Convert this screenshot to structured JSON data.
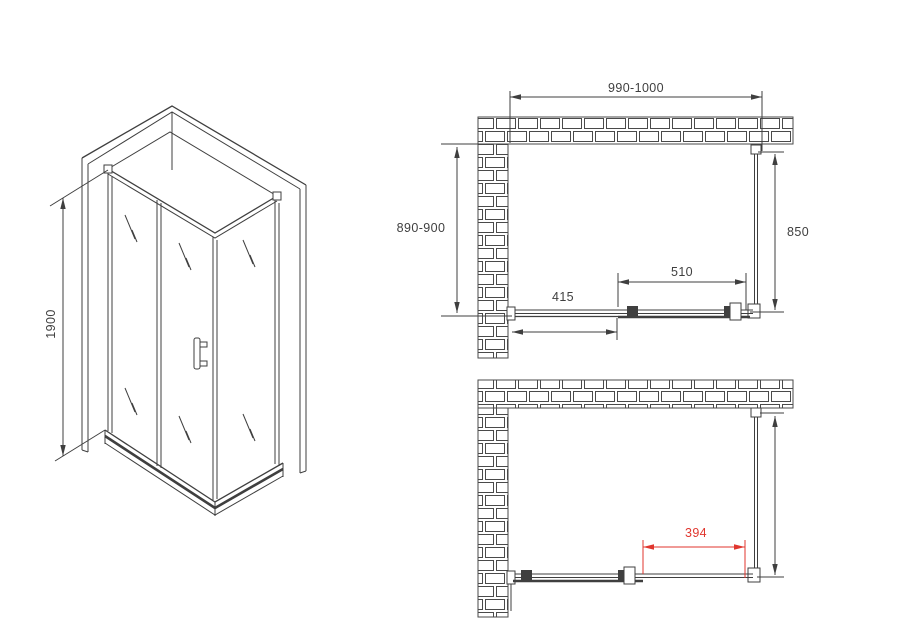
{
  "drawing": {
    "title_hint": "shower enclosure installation diagram",
    "colors": {
      "line": "#3f3f3f",
      "dimension_red": "#e0362e",
      "background": "#ffffff"
    },
    "iso_view": {
      "height": "1900"
    },
    "plan_closed": {
      "width": "990-1000",
      "depth": "890-900",
      "side_panel": "850",
      "door": "510",
      "fixed_panel": "415"
    },
    "plan_open": {
      "opening": "394"
    }
  }
}
